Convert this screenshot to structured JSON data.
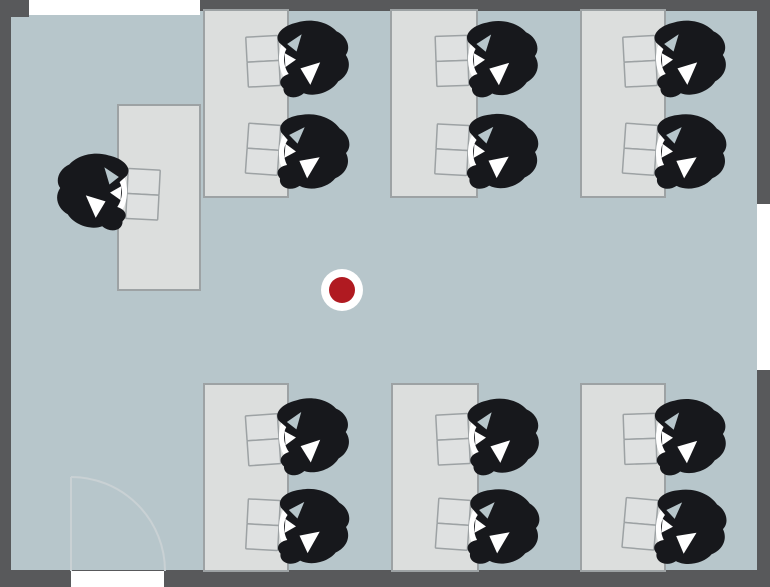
{
  "meta": {
    "title": "Top-down floor plan of a classroom/office with seated people",
    "legend": {
      "person_icon": "seated-person-top-view",
      "door_icon": "door-swing-arc",
      "marker_icon": "red-location-marker"
    },
    "counts": {
      "desks": 7,
      "people": 13,
      "windows": 2,
      "doors": 1,
      "markers": 1
    }
  },
  "colors": {
    "floor": "#b7c6cb",
    "wall": "#58595b",
    "window_white": "#ffffff",
    "desk_fill": "#dcdedd",
    "desk_stroke": "#9da2a4",
    "paper_fill": "#dfe1e1",
    "paper_stroke": "#9da2a4",
    "person": "#17181c",
    "door_line": "#c9d1d4",
    "marker_red": "#b01a21",
    "marker_ring": "#ffffff"
  },
  "room": {
    "width": 770,
    "height": 587,
    "walls": [
      {
        "side": "top",
        "x": 0,
        "y": 0,
        "w": 770,
        "h": 11
      },
      {
        "side": "left",
        "x": 0,
        "y": 0,
        "w": 11,
        "h": 587
      },
      {
        "side": "right",
        "x": 757,
        "y": 0,
        "w": 13,
        "h": 587
      },
      {
        "side": "bottom",
        "x": 0,
        "y": 570,
        "w": 770,
        "h": 17
      },
      {
        "side": "top-left-corner",
        "x": 0,
        "y": 0,
        "w": 29,
        "h": 17
      }
    ]
  },
  "windows": [
    {
      "side": "top",
      "x": 29,
      "y": 0,
      "w": 171,
      "h": 15
    },
    {
      "side": "right",
      "x": 757,
      "y": 204,
      "w": 13,
      "h": 166
    }
  ],
  "door": {
    "opening": {
      "x": 71,
      "y": 571,
      "w": 93,
      "h": 16
    },
    "leaf": {
      "x": 71,
      "y1": 477,
      "y2": 571
    },
    "arc": {
      "start_x": 71,
      "start_y": 477,
      "r": 94,
      "end_x": 165,
      "end_y": 571
    }
  },
  "marker": {
    "x": 342,
    "y": 290,
    "ring_r": 21,
    "dot_r": 13
  },
  "desks": [
    {
      "id": "left-single",
      "x": 118,
      "y": 105,
      "w": 82,
      "h": 185,
      "seats": [
        {
          "side": "left",
          "cy": 193,
          "tilt": 3
        }
      ]
    },
    {
      "id": "top-1",
      "x": 204,
      "y": 10,
      "w": 84,
      "h": 187,
      "seats": [
        {
          "side": "right",
          "cy": 60,
          "tilt": -3
        },
        {
          "side": "right",
          "cy": 151,
          "tilt": 4
        }
      ]
    },
    {
      "id": "top-2",
      "x": 391,
      "y": 10,
      "w": 86,
      "h": 187,
      "seats": [
        {
          "side": "right",
          "cy": 60,
          "tilt": -2
        },
        {
          "side": "right",
          "cy": 151,
          "tilt": 3
        }
      ]
    },
    {
      "id": "top-3",
      "x": 581,
      "y": 10,
      "w": 84,
      "h": 187,
      "seats": [
        {
          "side": "right",
          "cy": 60,
          "tilt": -3
        },
        {
          "side": "right",
          "cy": 151,
          "tilt": 4
        }
      ]
    },
    {
      "id": "bottom-1",
      "x": 204,
      "y": 384,
      "w": 84,
      "h": 187,
      "seats": [
        {
          "side": "right",
          "cy": 438,
          "tilt": -4
        },
        {
          "side": "right",
          "cy": 526,
          "tilt": 3
        }
      ]
    },
    {
      "id": "bottom-2",
      "x": 392,
      "y": 384,
      "w": 86,
      "h": 187,
      "seats": [
        {
          "side": "right",
          "cy": 438,
          "tilt": -3
        },
        {
          "side": "right",
          "cy": 526,
          "tilt": 4
        }
      ]
    },
    {
      "id": "bottom-3",
      "x": 581,
      "y": 384,
      "w": 84,
      "h": 187,
      "seats": [
        {
          "side": "right",
          "cy": 438,
          "tilt": -2
        },
        {
          "side": "right",
          "cy": 526,
          "tilt": 5
        }
      ]
    }
  ]
}
